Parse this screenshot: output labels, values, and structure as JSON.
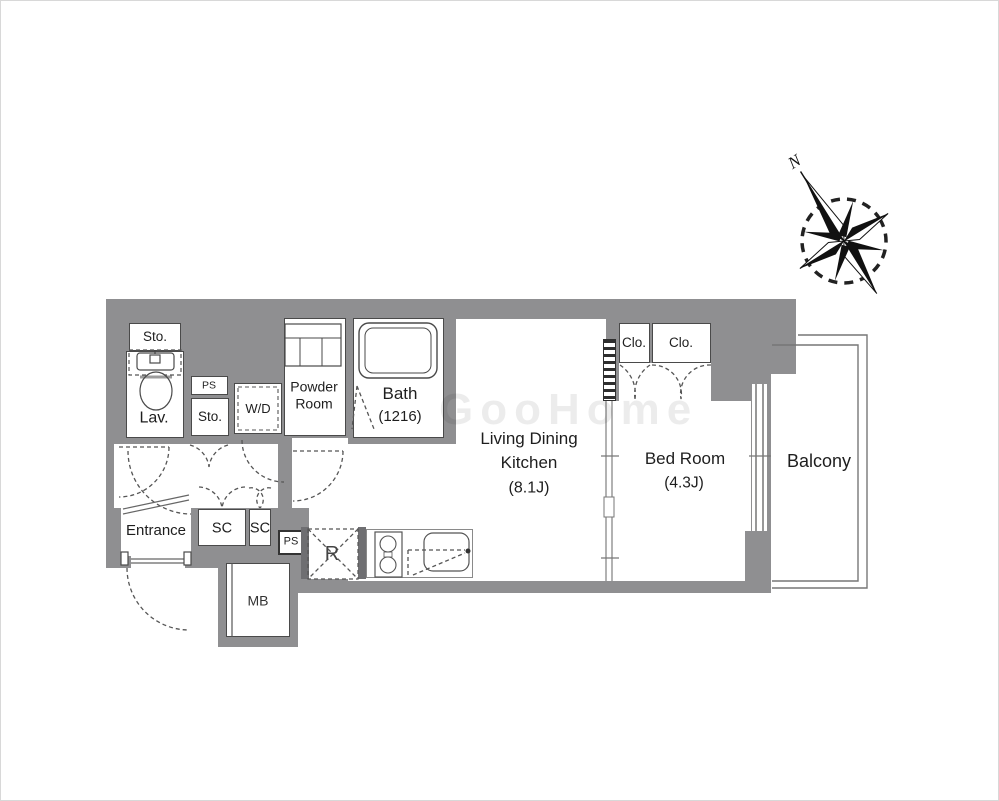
{
  "plan": {
    "rooms": {
      "sto_top": {
        "label": "Sto."
      },
      "lav": {
        "label": "Lav."
      },
      "ps_upper": {
        "label": "PS"
      },
      "sto_mid": {
        "label": "Sto."
      },
      "wd": {
        "label": "W/D"
      },
      "powder": {
        "line1": "Powder",
        "line2": "Room"
      },
      "bath": {
        "label": "Bath",
        "size": "(1216)"
      },
      "ldk": {
        "line1": "Living Dining",
        "line2": "Kitchen",
        "size": "(8.1J)"
      },
      "bedroom": {
        "label": "Bed Room",
        "size": "(4.3J)"
      },
      "closet_left": {
        "label": "Clo."
      },
      "closet_right": {
        "label": "Clo."
      },
      "balcony": {
        "label": "Balcony"
      },
      "entrance": {
        "label": "Entrance"
      },
      "shoe_closet_left": {
        "label": "SC"
      },
      "shoe_closet_right": {
        "label": "SC"
      },
      "ps_lower": {
        "label": "PS"
      },
      "refrigerator": {
        "label": "R"
      },
      "meter_box": {
        "label": "MB"
      }
    },
    "compass": {
      "north_label": "N"
    },
    "watermark": {
      "text": "GooHome"
    },
    "icons": [
      "compass-rose",
      "toilet",
      "bathtub",
      "vanity-sink",
      "kitchen-sink",
      "stove",
      "washer-space",
      "refrigerator-space"
    ],
    "colors": {
      "wall": "#8f8f91",
      "wall_dark": "#6f6f72",
      "line": "#4a4a4a",
      "text": "#1e1e1e"
    }
  }
}
